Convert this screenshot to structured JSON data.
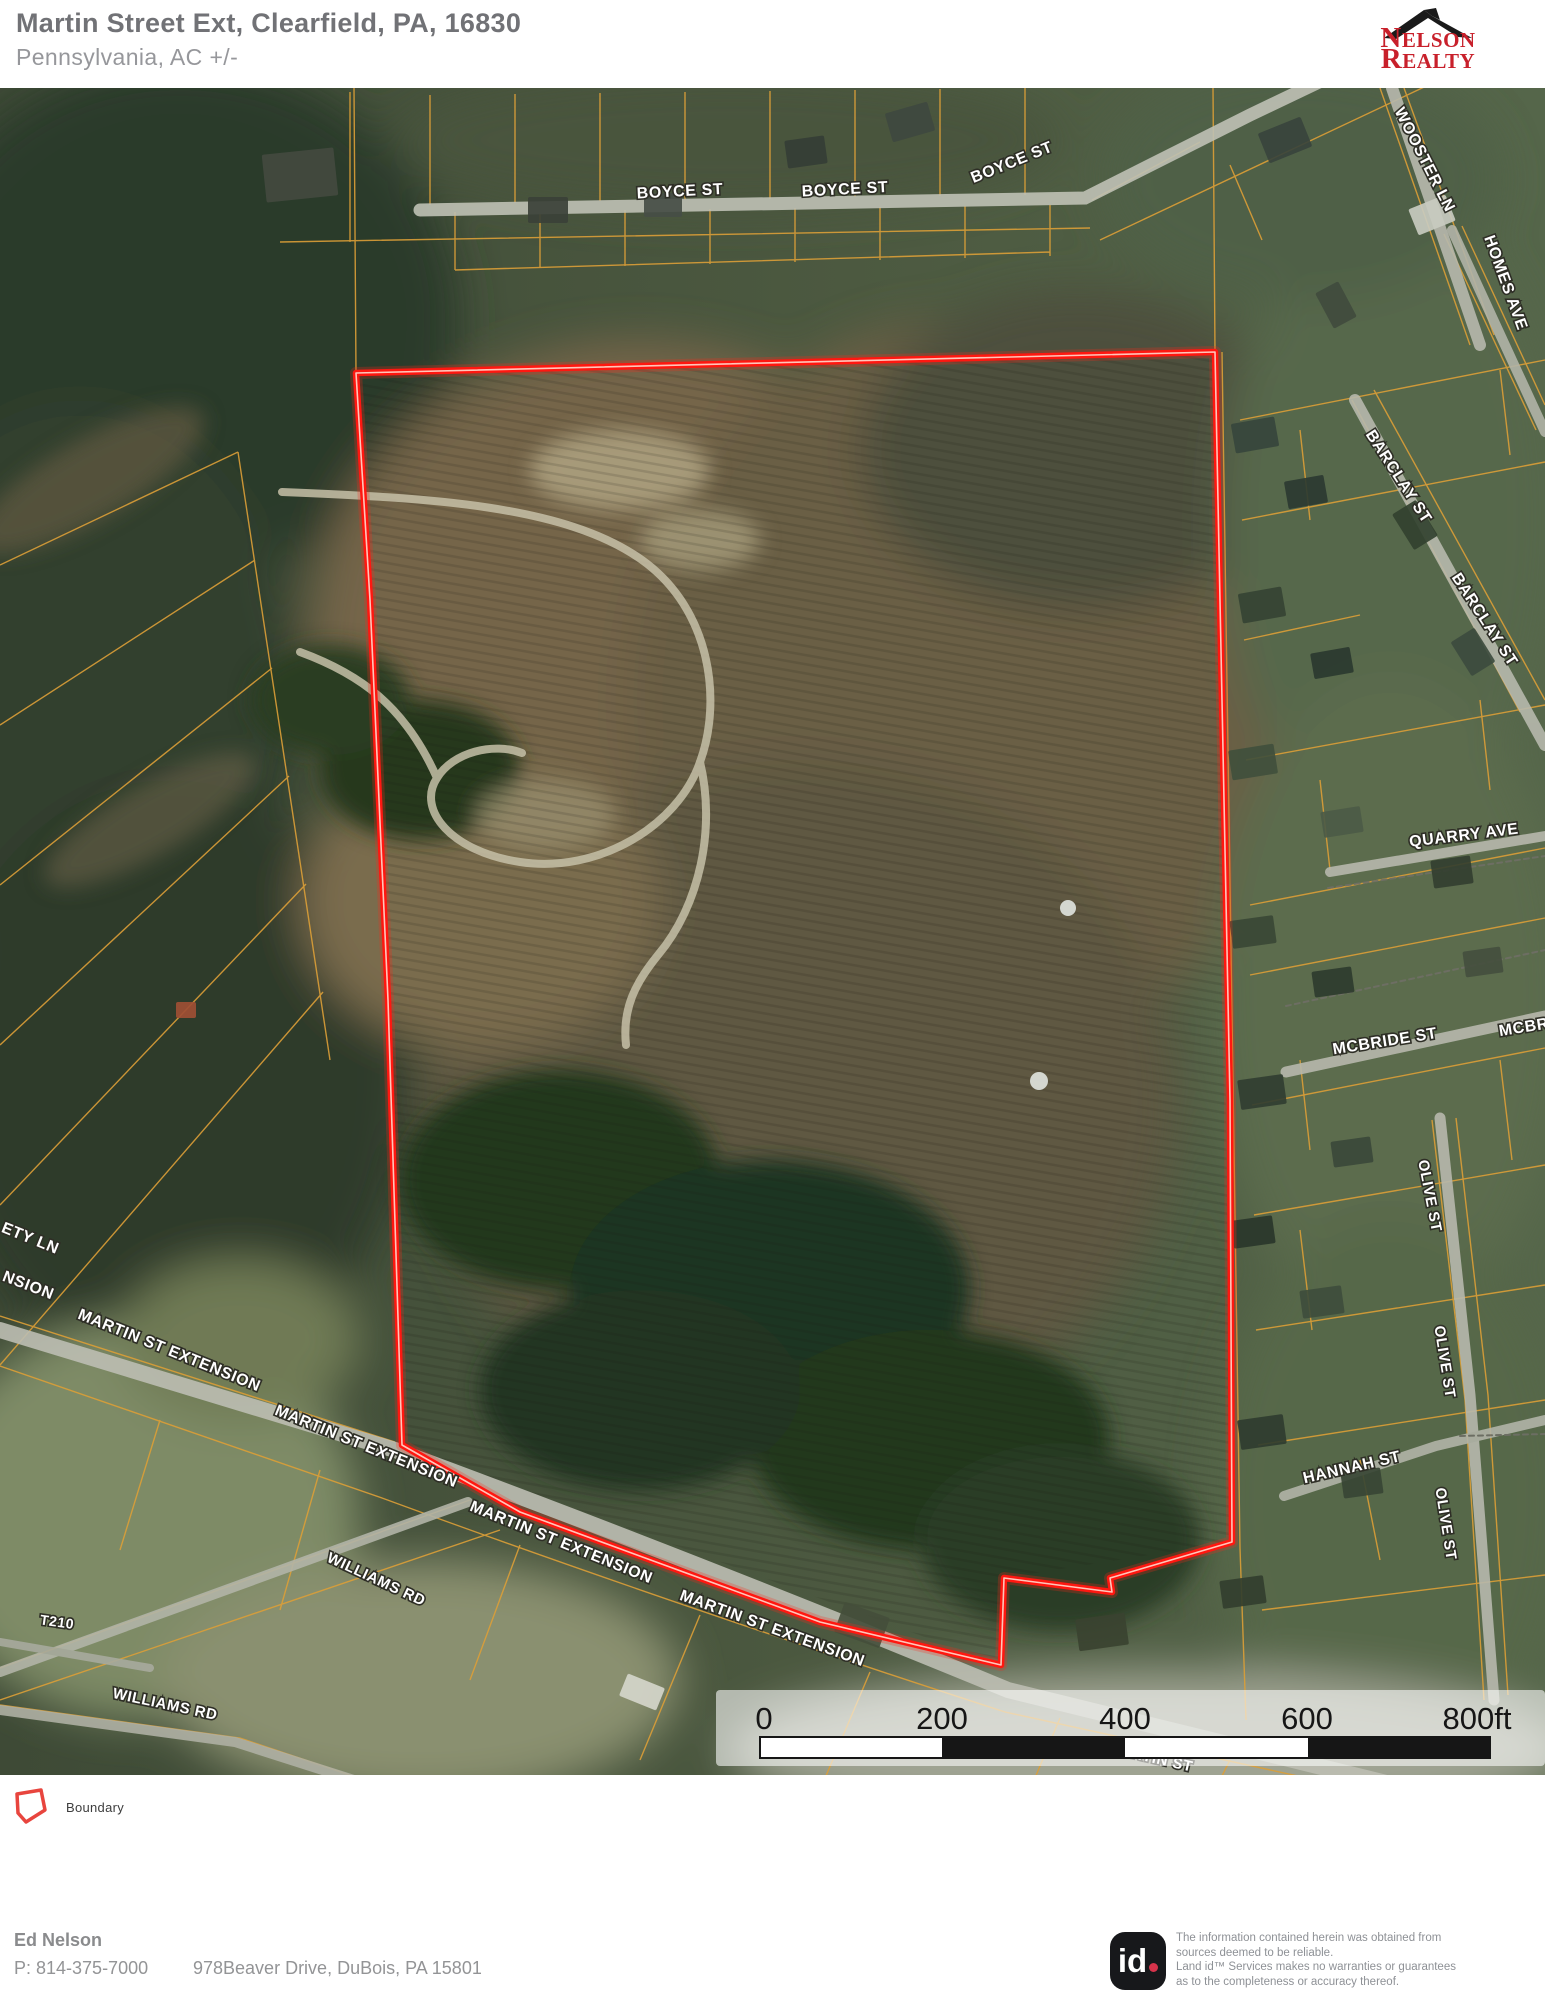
{
  "header": {
    "title": "Martin Street Ext, Clearfield, PA, 16830",
    "subtitle": "Pennsylvania,  AC +/-",
    "logo": {
      "n": "N",
      "elson": "ELSON",
      "r": "R",
      "ealty": "EALTY"
    }
  },
  "map": {
    "boundary": {
      "color": "#ff1710",
      "core_color": "#ffd9cd",
      "points": [
        [
          356,
          373
        ],
        [
          1215,
          352
        ],
        [
          1222,
          700
        ],
        [
          1230,
          1100
        ],
        [
          1232,
          1542
        ],
        [
          1110,
          1578
        ],
        [
          1112,
          1592
        ],
        [
          1004,
          1578
        ],
        [
          1001,
          1665
        ],
        [
          820,
          1622
        ],
        [
          637,
          1555
        ],
        [
          520,
          1512
        ],
        [
          402,
          1445
        ],
        [
          388,
          1000
        ],
        [
          370,
          600
        ]
      ]
    },
    "street_labels": [
      {
        "t": "BOYCE ST",
        "x": 680,
        "y": 192,
        "r": -3,
        "s": 16
      },
      {
        "t": "BOYCE ST",
        "x": 845,
        "y": 190,
        "r": -3,
        "s": 16
      },
      {
        "t": "BOYCE ST",
        "x": 1012,
        "y": 163,
        "r": -22,
        "s": 16
      },
      {
        "t": "WOOSTER LN",
        "x": 1424,
        "y": 160,
        "r": 63,
        "s": 16
      },
      {
        "t": "HOMES AVE",
        "x": 1505,
        "y": 283,
        "r": 70,
        "s": 16
      },
      {
        "t": "BARCLAY ST",
        "x": 1398,
        "y": 477,
        "r": 57,
        "s": 16
      },
      {
        "t": "BARCLAY ST",
        "x": 1484,
        "y": 620,
        "r": 57,
        "s": 16
      },
      {
        "t": "QUARRY AVE",
        "x": 1464,
        "y": 836,
        "r": -7,
        "s": 16
      },
      {
        "t": "MCBRIDE ST",
        "x": 1385,
        "y": 1042,
        "r": -9,
        "s": 16
      },
      {
        "t": "MCBR",
        "x": 1524,
        "y": 1028,
        "r": -9,
        "s": 16
      },
      {
        "t": "OLIVE ST",
        "x": 1429,
        "y": 1196,
        "r": 79,
        "s": 15
      },
      {
        "t": "OLIVE ST",
        "x": 1444,
        "y": 1362,
        "r": 81,
        "s": 15
      },
      {
        "t": "OLIVE ST",
        "x": 1445,
        "y": 1524,
        "r": 81,
        "s": 15
      },
      {
        "t": "HANNAH ST",
        "x": 1352,
        "y": 1468,
        "r": -13,
        "s": 16
      },
      {
        "t": "ETY LN",
        "x": 30,
        "y": 1239,
        "r": 22,
        "s": 16
      },
      {
        "t": "NSION",
        "x": 28,
        "y": 1286,
        "r": 21,
        "s": 16
      },
      {
        "t": "MARTIN ST EXTENSION",
        "x": 169,
        "y": 1351,
        "r": 22,
        "s": 16
      },
      {
        "t": "MARTIN ST EXTENSION",
        "x": 366,
        "y": 1447,
        "r": 22,
        "s": 16
      },
      {
        "t": "MARTIN ST EXTENSION",
        "x": 561,
        "y": 1543,
        "r": 22,
        "s": 16
      },
      {
        "t": "MARTIN ST EXTENSION",
        "x": 772,
        "y": 1629,
        "r": 20,
        "s": 16
      },
      {
        "t": "WILLIAMS RD",
        "x": 376,
        "y": 1580,
        "r": 25,
        "s": 15
      },
      {
        "t": "T210",
        "x": 57,
        "y": 1623,
        "r": 8,
        "s": 14
      },
      {
        "t": "WILLIAMS RD",
        "x": 165,
        "y": 1705,
        "r": 12,
        "s": 15
      },
      {
        "t": "MARTIN ST",
        "x": 1150,
        "y": 1758,
        "r": 13,
        "s": 15
      },
      {
        "t": "S",
        "x": 1462,
        "y": 1750,
        "r": 80,
        "s": 14
      }
    ],
    "scalebar": {
      "panel": {
        "x": 716,
        "y": 1690,
        "w": 829,
        "h": 76
      },
      "bar": {
        "x": 760,
        "y": 1737,
        "w": 730,
        "h": 21
      },
      "segments": [
        {
          "x": 760,
          "w": 182,
          "fill": "#ffffff"
        },
        {
          "x": 942,
          "w": 183,
          "fill": "#161616"
        },
        {
          "x": 1125,
          "w": 183,
          "fill": "#ffffff"
        },
        {
          "x": 1308,
          "w": 182,
          "fill": "#161616"
        }
      ],
      "labels": [
        {
          "text": "0",
          "x": 764
        },
        {
          "text": "200",
          "x": 942
        },
        {
          "text": "400",
          "x": 1125
        },
        {
          "text": "600",
          "x": 1307
        },
        {
          "text": "800ft",
          "x": 1477
        }
      ]
    }
  },
  "legend": {
    "label": "Boundary"
  },
  "footer": {
    "agent": "Ed Nelson",
    "phone": "P: 814-375-7000",
    "address": "978Beaver Drive, DuBois, PA 15801",
    "id_text": "id",
    "disclaimer": [
      "The information contained herein was obtained from",
      "sources deemed to be reliable.",
      " Land id™ Services makes no warranties or guarantees",
      "as to the completeness or accuracy thereof."
    ]
  }
}
